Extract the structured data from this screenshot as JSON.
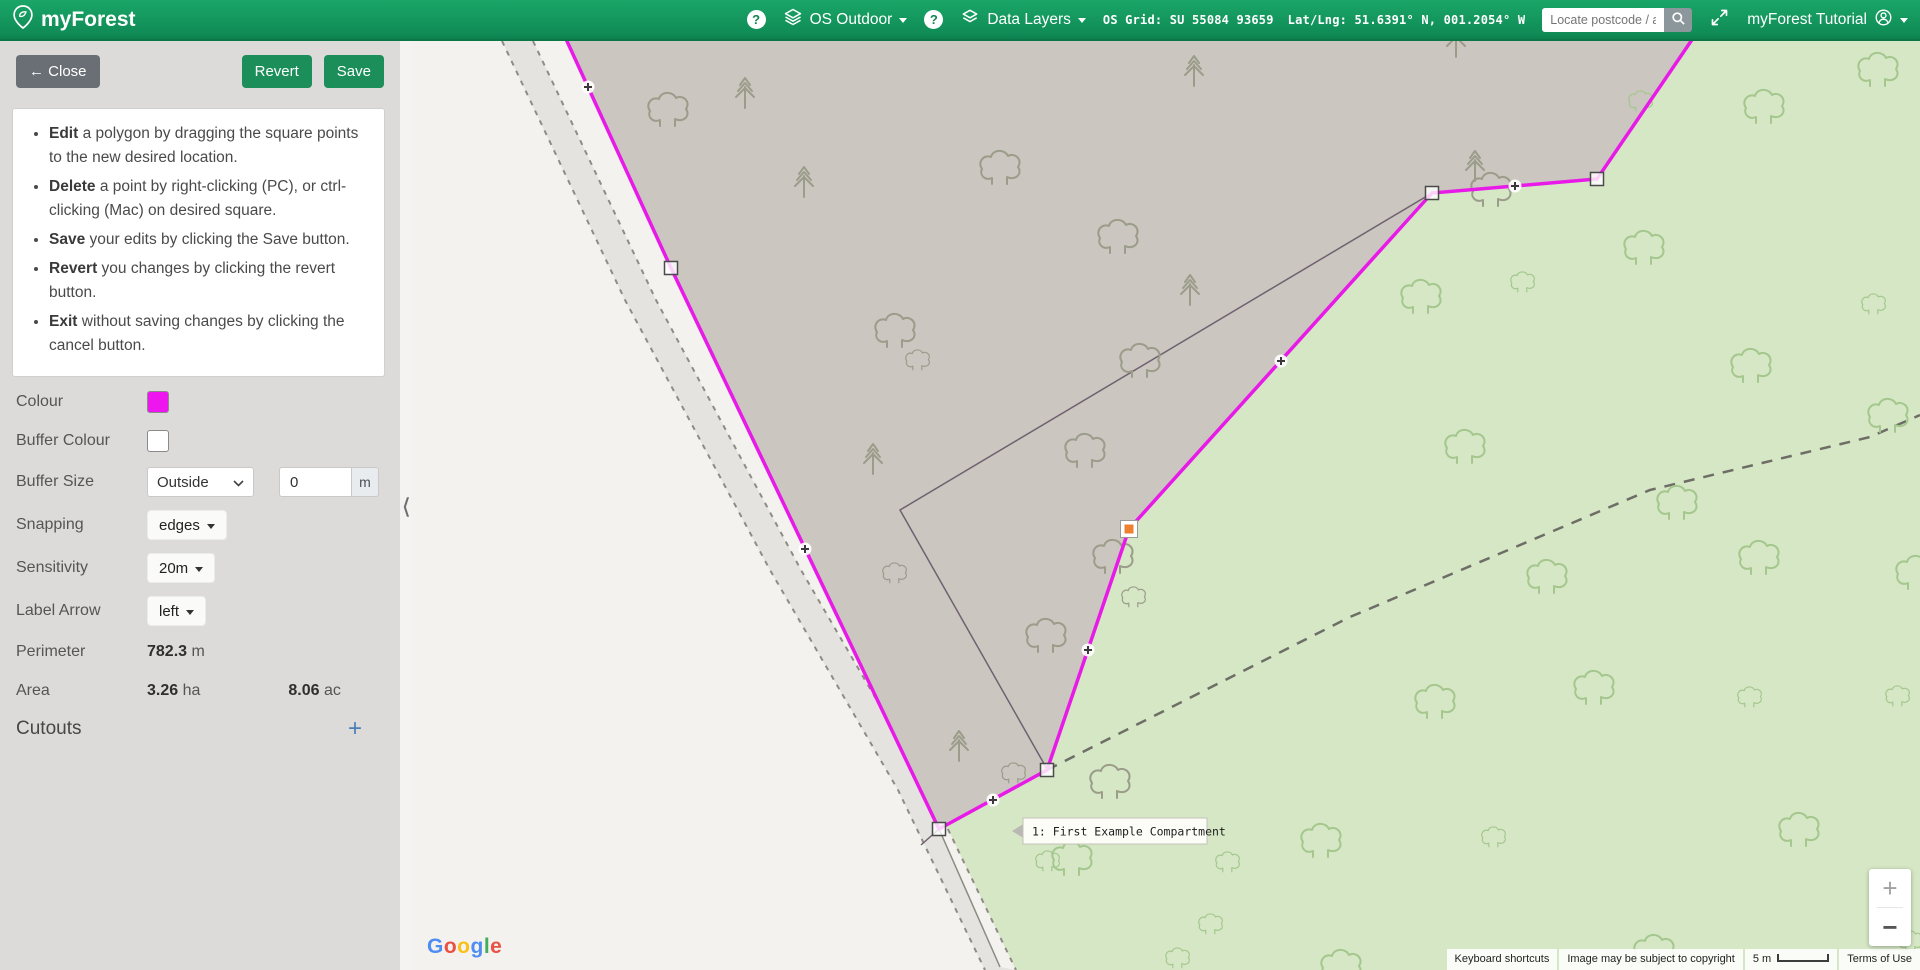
{
  "navbar": {
    "brand": "myForest",
    "help_icon": "?",
    "basemap_label": "OS Outdoor",
    "layers_label": "Data Layers",
    "os_grid": "OS Grid: SU 55084 93659",
    "latlng": "Lat/Lng: 51.6391° N, 001.2054° W",
    "search_placeholder": "Locate postcode / address",
    "account_label": "myForest Tutorial"
  },
  "sidebar": {
    "close_icon": "←",
    "close_label": "Close",
    "revert_label": "Revert",
    "save_label": "Save",
    "collapse_icon": "❮",
    "instructions": [
      {
        "lead": "Edit",
        "rest": " a polygon by dragging the square points to the new desired location."
      },
      {
        "lead": "Delete",
        "rest": " a point by right-clicking (PC), or ctrl-clicking (Mac) on desired square."
      },
      {
        "lead": "Save",
        "rest": " your edits by clicking the Save button."
      },
      {
        "lead": "Revert",
        "rest": " you changes by clicking the revert button."
      },
      {
        "lead": "Exit",
        "rest": " without saving changes by clicking the cancel button."
      }
    ],
    "fields": {
      "colour_label": "Colour",
      "buffer_colour_label": "Buffer Colour",
      "buffer_size_label": "Buffer Size",
      "buffer_size_mode": "Outside",
      "buffer_size_value": "0",
      "buffer_size_unit": "m",
      "snapping_label": "Snapping",
      "snapping_value": "edges",
      "sensitivity_label": "Sensitivity",
      "sensitivity_value": "20m",
      "label_arrow_label": "Label Arrow",
      "label_arrow_value": "left",
      "perimeter_label": "Perimeter",
      "perimeter_value": "782.3",
      "perimeter_unit": "m",
      "area_label": "Area",
      "area_ha_value": "3.26",
      "area_ha_unit": "ha",
      "area_ac_value": "8.06",
      "area_ac_unit": "ac",
      "cutouts_label": "Cutouts",
      "cutouts_add": "+"
    },
    "colors": {
      "colour_swatch": "#ee16ee",
      "buffer_swatch": "#ffffff"
    }
  },
  "map": {
    "label": "1: First Example Compartment",
    "attribution": "Google",
    "logo_colors": [
      "#4285F4",
      "#EA4335",
      "#FBBC05",
      "#4285F4",
      "#34A853",
      "#EA4335"
    ],
    "footer": {
      "shortcuts": "Keyboard shortcuts",
      "copyright": "Image may be subject to copyright",
      "scale": "5 m",
      "terms": "Terms of Use"
    },
    "zoom_in": "+",
    "zoom_out": "−",
    "colors": {
      "green_field": "#d5e7c5",
      "compartment_fill": "#cbc6c0",
      "road": "#e5e3e0",
      "outer_field": "#f4f2ef",
      "dash": "#8f8c85",
      "tree_green": "#a5c78e",
      "tree_grey": "#9b9c8a",
      "boundary_dash": "#6e6e66",
      "old_line": "#6f6170",
      "green_boundary": "#8b8b80",
      "magenta": "#e81ae8",
      "selected_vertex": "#ee8130"
    },
    "geometry": {
      "width": 1508,
      "height": 929,
      "compartment": [
        [
          93,
          -135
        ],
        [
          259,
          227
        ],
        [
          527,
          788
        ],
        [
          635,
          729
        ],
        [
          717,
          488
        ],
        [
          1020,
          152
        ],
        [
          1185,
          138
        ],
        [
          1348,
          -101
        ]
      ],
      "vertices": [
        [
          259,
          227
        ],
        [
          527,
          788
        ],
        [
          635,
          729
        ],
        [
          1020,
          152
        ],
        [
          1185,
          138
        ]
      ],
      "selected_vertex": [
        717,
        488
      ],
      "midpoints": [
        [
          176,
          46
        ],
        [
          393,
          508
        ],
        [
          581,
          759
        ],
        [
          676,
          609
        ],
        [
          869,
          320
        ],
        [
          1103,
          145
        ]
      ],
      "road_left": [
        [
          90,
          0
        ],
        [
          213,
          259
        ],
        [
          358,
          529
        ],
        [
          486,
          749
        ],
        [
          573,
          929
        ]
      ],
      "road_right": [
        [
          121,
          0
        ],
        [
          244,
          259
        ],
        [
          389,
          529
        ],
        [
          517,
          749
        ],
        [
          604,
          929
        ]
      ],
      "outer_field": [
        [
          0,
          0
        ],
        [
          90,
          0
        ],
        [
          213,
          259
        ],
        [
          358,
          529
        ],
        [
          486,
          749
        ],
        [
          573,
          929
        ],
        [
          0,
          929
        ]
      ],
      "verge": [
        [
          121,
          0
        ],
        [
          244,
          259
        ],
        [
          389,
          529
        ],
        [
          517,
          749
        ],
        [
          604,
          929
        ],
        [
          588,
          926
        ],
        [
          527,
          788
        ],
        [
          259,
          227
        ],
        [
          155,
          0
        ]
      ],
      "old_lines": [
        [
          [
            1020,
            152
          ],
          [
            488,
            469
          ],
          [
            635,
            728
          ]
        ],
        [
          [
            527,
            788
          ],
          [
            509,
            804
          ]
        ]
      ],
      "green_boundary": [
        [
          527,
          788
        ],
        [
          588,
          926
        ]
      ],
      "dashed_boundary": [
        [
          635,
          729
        ],
        [
          938,
          576
        ],
        [
          1238,
          449
        ],
        [
          1458,
          396
        ],
        [
          1508,
          374
        ]
      ],
      "label_pos": [
        600,
        790
      ]
    },
    "trees": {
      "grey": {
        "conifers": [
          [
            333,
            51
          ],
          [
            392,
            140
          ],
          [
            782,
            29
          ],
          [
            778,
            248
          ],
          [
            461,
            417
          ],
          [
            547,
            704
          ],
          [
            1063,
            124
          ],
          [
            1044,
            0
          ]
        ],
        "clouds": [
          [
            255,
            72,
            1
          ],
          [
            587,
            130,
            1
          ],
          [
            705,
            199,
            1
          ],
          [
            482,
            293,
            1
          ],
          [
            505,
            321,
            0.6
          ],
          [
            727,
            323,
            1
          ],
          [
            672,
            413,
            1
          ],
          [
            700,
            519,
            1
          ],
          [
            721,
            558,
            0.6
          ],
          [
            633,
            598,
            1
          ],
          [
            601,
            734,
            0.6
          ],
          [
            697,
            744,
            1
          ],
          [
            1078,
            152,
            1
          ],
          [
            482,
            534,
            0.6
          ]
        ]
      },
      "green": {
        "clouds": [
          [
            1008,
            259,
            1
          ],
          [
            1231,
            210,
            1
          ],
          [
            1465,
            32,
            1
          ],
          [
            1351,
            69,
            1
          ],
          [
            1228,
            62,
            0.6
          ],
          [
            1052,
            409,
            1
          ],
          [
            1338,
            328,
            1
          ],
          [
            1264,
            465,
            1
          ],
          [
            1475,
            378,
            1
          ],
          [
            1134,
            539,
            1
          ],
          [
            1346,
            520,
            1
          ],
          [
            1022,
            664,
            1
          ],
          [
            1181,
            650,
            1
          ],
          [
            908,
            803,
            1
          ],
          [
            659,
            821,
            1
          ],
          [
            928,
            929,
            1
          ],
          [
            1110,
            243,
            0.6
          ],
          [
            1461,
            265,
            0.6
          ],
          [
            1337,
            658,
            0.6
          ],
          [
            1485,
            657,
            0.6
          ],
          [
            1081,
            798,
            0.6
          ],
          [
            1241,
            914,
            1
          ],
          [
            1386,
            792,
            1
          ],
          [
            1498,
            902,
            0.6
          ],
          [
            798,
            885,
            0.6
          ],
          [
            815,
            823,
            0.6
          ],
          [
            635,
            822,
            0.6
          ],
          [
            765,
            919,
            0.6
          ],
          [
            1503,
            535,
            1
          ]
        ]
      }
    }
  }
}
